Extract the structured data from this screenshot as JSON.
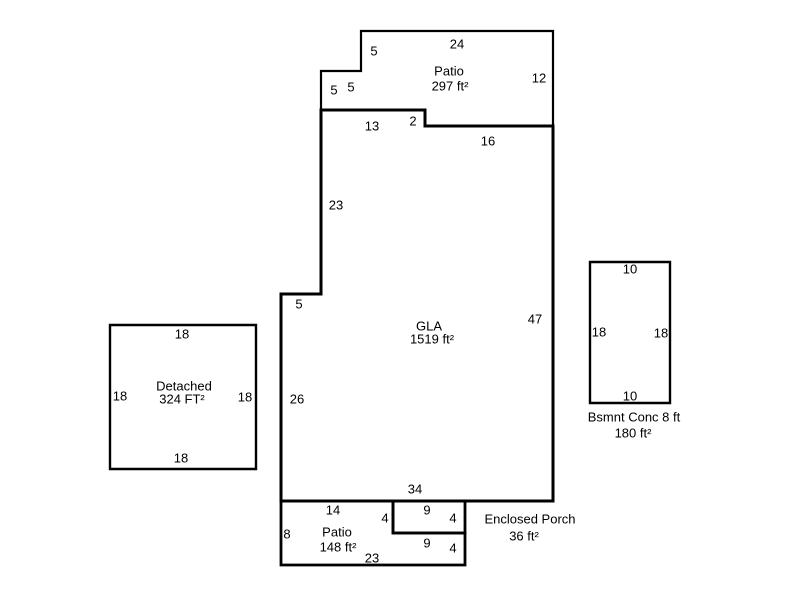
{
  "canvas": {
    "width": 800,
    "height": 600,
    "background_color": "#ffffff",
    "line_color": "#000000",
    "text_color": "#000000"
  },
  "structures": [
    {
      "id": "gla",
      "outline": {
        "points": [
          [
            321,
            110
          ],
          [
            425,
            110
          ],
          [
            425,
            126
          ],
          [
            553,
            126
          ],
          [
            553,
            501
          ],
          [
            281,
            501
          ],
          [
            281,
            294
          ],
          [
            321,
            294
          ]
        ],
        "stroke_px": 3
      },
      "texts": [
        {
          "name": "gla-name",
          "text": "GLA",
          "x": 429,
          "y": 326
        },
        {
          "name": "gla-area",
          "text": "1519 ft²",
          "x": 432,
          "y": 339
        },
        {
          "name": "dim-gla-top-13",
          "text": "13",
          "x": 372,
          "y": 126
        },
        {
          "name": "dim-gla-step-2",
          "text": "2",
          "x": 413,
          "y": 121
        },
        {
          "name": "dim-gla-topright-16",
          "text": "16",
          "x": 488,
          "y": 141
        },
        {
          "name": "dim-gla-left-upper-23",
          "text": "23",
          "x": 336,
          "y": 205
        },
        {
          "name": "dim-gla-jog-5",
          "text": "5",
          "x": 299,
          "y": 304
        },
        {
          "name": "dim-gla-right-47",
          "text": "47",
          "x": 535,
          "y": 319
        },
        {
          "name": "dim-gla-left-lower-26",
          "text": "26",
          "x": 297,
          "y": 399
        },
        {
          "name": "dim-gla-bottom-34",
          "text": "34",
          "x": 415,
          "y": 489
        }
      ]
    },
    {
      "id": "patio_top",
      "outline": {
        "points": [
          [
            361,
            31
          ],
          [
            553,
            31
          ],
          [
            553,
            126
          ],
          [
            425,
            126
          ],
          [
            425,
            110
          ],
          [
            321,
            110
          ],
          [
            321,
            71
          ],
          [
            361,
            71
          ]
        ],
        "stroke_px": 2.2
      },
      "texts": [
        {
          "name": "patio-top-name",
          "text": "Patio",
          "x": 449,
          "y": 71
        },
        {
          "name": "patio-top-area",
          "text": "297 ft²",
          "x": 450,
          "y": 86
        },
        {
          "name": "dim-patio-top-left-5",
          "text": "5",
          "x": 374,
          "y": 51
        },
        {
          "name": "dim-patio-top-24",
          "text": "24",
          "x": 457,
          "y": 44
        },
        {
          "name": "dim-patio-top-right-12",
          "text": "12",
          "x": 539,
          "y": 78
        },
        {
          "name": "dim-patio-top-step-h-5",
          "text": "5",
          "x": 351,
          "y": 87
        },
        {
          "name": "dim-patio-top-step-v-5",
          "text": "5",
          "x": 334,
          "y": 90
        }
      ]
    },
    {
      "id": "detached",
      "outline": {
        "points": [
          [
            110,
            325
          ],
          [
            256,
            325
          ],
          [
            256,
            469
          ],
          [
            110,
            469
          ]
        ],
        "stroke_px": 2.4
      },
      "texts": [
        {
          "name": "detached-name",
          "text": "Detached",
          "x": 184,
          "y": 386
        },
        {
          "name": "detached-area",
          "text": "324 FT²",
          "x": 182,
          "y": 399
        },
        {
          "name": "dim-detached-top-18",
          "text": "18",
          "x": 182,
          "y": 334
        },
        {
          "name": "dim-detached-left-18",
          "text": "18",
          "x": 120,
          "y": 396
        },
        {
          "name": "dim-detached-right-18",
          "text": "18",
          "x": 245,
          "y": 397
        },
        {
          "name": "dim-detached-bottom-18",
          "text": "18",
          "x": 181,
          "y": 458
        }
      ]
    },
    {
      "id": "bsmnt_conc",
      "outline": {
        "points": [
          [
            590,
            262
          ],
          [
            670,
            262
          ],
          [
            670,
            403
          ],
          [
            590,
            403
          ]
        ],
        "stroke_px": 2.4
      },
      "texts": [
        {
          "name": "bsmnt-name",
          "text": "Bsmnt Conc 8 ft",
          "x": 634,
          "y": 417
        },
        {
          "name": "bsmnt-area",
          "text": "180 ft²",
          "x": 633,
          "y": 433
        },
        {
          "name": "dim-bsmnt-top-10",
          "text": "10",
          "x": 630,
          "y": 269
        },
        {
          "name": "dim-bsmnt-left-18",
          "text": "18",
          "x": 599,
          "y": 332
        },
        {
          "name": "dim-bsmnt-right-18",
          "text": "18",
          "x": 661,
          "y": 333
        },
        {
          "name": "dim-bsmnt-bottom-10",
          "text": "10",
          "x": 630,
          "y": 396
        }
      ]
    },
    {
      "id": "patio_bottom",
      "outline": {
        "points": [
          [
            281,
            501
          ],
          [
            393,
            501
          ],
          [
            393,
            533
          ],
          [
            465,
            533
          ],
          [
            465,
            565
          ],
          [
            281,
            565
          ]
        ],
        "stroke_px": 2.8
      },
      "texts": [
        {
          "name": "patio-bottom-name",
          "text": "Patio",
          "x": 337,
          "y": 532
        },
        {
          "name": "patio-bottom-area",
          "text": "148 ft²",
          "x": 338,
          "y": 547
        },
        {
          "name": "dim-patio-bottom-top-14",
          "text": "14",
          "x": 333,
          "y": 510
        },
        {
          "name": "dim-patio-bottom-left-8",
          "text": "8",
          "x": 287,
          "y": 534
        },
        {
          "name": "dim-patio-bottom-bottom-23",
          "text": "23",
          "x": 372,
          "y": 558
        },
        {
          "name": "dim-patio-bottom-right-4",
          "text": "4",
          "x": 453,
          "y": 548
        }
      ]
    },
    {
      "id": "enclosed_porch",
      "outline": {
        "points": [
          [
            393,
            501
          ],
          [
            465,
            501
          ],
          [
            465,
            533
          ],
          [
            393,
            533
          ]
        ],
        "stroke_px": 2.8
      },
      "texts": [
        {
          "name": "porch-name",
          "text": "Enclosed Porch",
          "x": 530,
          "y": 519
        },
        {
          "name": "porch-area",
          "text": "36 ft²",
          "x": 524,
          "y": 536
        },
        {
          "name": "dim-porch-top-9",
          "text": "9",
          "x": 427,
          "y": 510
        },
        {
          "name": "dim-porch-left-4",
          "text": "4",
          "x": 385,
          "y": 518
        },
        {
          "name": "dim-porch-right-4",
          "text": "4",
          "x": 453,
          "y": 518
        },
        {
          "name": "dim-porch-bottom-9",
          "text": "9",
          "x": 427,
          "y": 543
        }
      ]
    }
  ]
}
